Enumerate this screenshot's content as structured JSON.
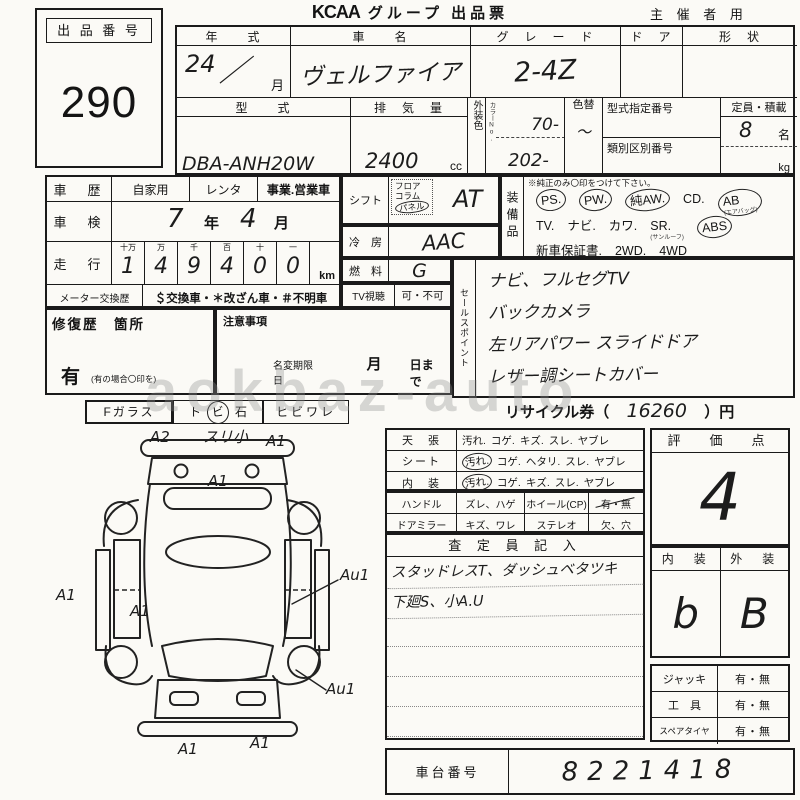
{
  "header": {
    "logo": "KCAA",
    "title": "グループ 出品票",
    "audience": "主 催 者 用"
  },
  "lot": {
    "label": "出 品 番 号",
    "number": "290"
  },
  "top": {
    "year": {
      "label": "年　　式",
      "value": "24",
      "slash": "／",
      "month": "月"
    },
    "name": {
      "label": "車　　名",
      "value": "ヴェルファイア"
    },
    "grade": {
      "label": "グ　レ　ー　ド",
      "value": "2-4Z"
    },
    "door": {
      "label": "ド　ア"
    },
    "shape": {
      "label": "形　状"
    },
    "model": {
      "label": "型　　式",
      "value": "DBA-ANH20W"
    },
    "disp": {
      "label": "排　気　量",
      "value": "2400",
      "unit": "cc"
    },
    "color": {
      "label": "外装色",
      "sub": "カラーNo.",
      "top": "70-",
      "bottom": "202-"
    },
    "colorchg": {
      "label": "色替",
      "value": "〜"
    },
    "typenum": {
      "label": "型式指定番号"
    },
    "classnum": {
      "label": "類別区別番号"
    },
    "capacity": {
      "label": "定員・積載",
      "value": "8",
      "unit1": "名",
      "unit2": "kg"
    }
  },
  "history": {
    "use": {
      "label": "車　歴",
      "options": [
        "自家用",
        "レンタ",
        "事業.営業車"
      ]
    },
    "shaken": {
      "label": "車　検",
      "year": "7",
      "year_unit": "年",
      "month": "4",
      "month_unit": "月"
    },
    "odo": {
      "label": "走　行",
      "columns": [
        {
          "h": "十万",
          "d": "1"
        },
        {
          "h": "万",
          "d": "4"
        },
        {
          "h": "千",
          "d": "9"
        },
        {
          "h": "百",
          "d": "4"
        },
        {
          "h": "十",
          "d": "0"
        },
        {
          "h": "一",
          "d": "0"
        }
      ],
      "unit": "km"
    },
    "meter": {
      "label": "メーター交換歴",
      "legend": "＄交換車・＊改ざん車・＃不明車"
    }
  },
  "tv": {
    "label": "TV視聴",
    "value": "可・不可"
  },
  "shift": {
    "label": "シフト",
    "options": [
      {
        "t": "フロア"
      },
      {
        "t": "コラム"
      },
      {
        "t": "パネル",
        "c": 1
      }
    ],
    "value": "AT"
  },
  "ac": {
    "label": "冷　房",
    "value": "AAC"
  },
  "fuel": {
    "label": "燃　料",
    "value": "G"
  },
  "repair": {
    "label": "修復歴　箇所",
    "flag": "有",
    "note": "(有の場合〇印を)"
  },
  "caution": {
    "label": "注意事項",
    "rename": "名変期限日",
    "month": "月",
    "until": "日まで"
  },
  "equipment": {
    "label": "装備品",
    "note": "※純正のみ〇印をつけて下さい。",
    "lines": [
      [
        {
          "t": "PS.",
          "c": 1
        },
        {
          "t": "PW.",
          "c": 1
        },
        {
          "t": "純AW.",
          "c": 1
        },
        {
          "t": "CD."
        },
        {
          "t": "AB",
          "c": 1,
          "sub": "(エアバッグ)"
        }
      ],
      [
        {
          "t": "TV."
        },
        {
          "t": "ナビ."
        },
        {
          "t": "カワ."
        },
        {
          "t": "SR.",
          "sub": "(サンルーフ)"
        },
        {
          "t": "ABS",
          "c": 1
        }
      ],
      [
        {
          "t": "新車保証書."
        },
        {
          "t": "2WD."
        },
        {
          "t": "4WD"
        }
      ]
    ]
  },
  "sales": {
    "label": "セールスポイント",
    "lines": [
      "ナビ、フルセグTV",
      "バックカメラ",
      "左リアパワー スライドドア",
      "レザー調シートカバー"
    ]
  },
  "glass": {
    "label": "Fガラス",
    "parts": [
      {
        "t": "ト"
      },
      {
        "t": "ビ",
        "c": 1
      },
      {
        "t": "石"
      }
    ],
    "crack": "ヒビワレ"
  },
  "recycle": {
    "prefix": "リサイクル券（",
    "value": "16260",
    "suffix": "）円"
  },
  "condition": {
    "rows": [
      {
        "label": "天　張",
        "options": [
          {
            "t": "汚れ."
          },
          {
            "t": "コゲ."
          },
          {
            "t": "キズ."
          },
          {
            "t": "スレ."
          },
          {
            "t": "ヤブレ"
          }
        ]
      },
      {
        "label": "シート",
        "options": [
          {
            "t": "汚れ.",
            "c": 1
          },
          {
            "t": "コゲ."
          },
          {
            "t": "ヘタリ."
          },
          {
            "t": "スレ."
          },
          {
            "t": "ヤブレ"
          }
        ]
      },
      {
        "label": "内　装",
        "options": [
          {
            "t": "汚れ.",
            "c": 1
          },
          {
            "t": "コゲ."
          },
          {
            "t": "キズ."
          },
          {
            "t": "スレ."
          },
          {
            "t": "ヤブレ"
          }
        ]
      }
    ],
    "rows2": [
      {
        "cells": [
          "ハンドル",
          "ズレ、ハゲ",
          "ホイール(CP)",
          "有・無"
        ],
        "marked": true
      },
      {
        "cells": [
          "ドアミラー",
          "キズ、ワレ",
          "ステレオ",
          "欠、穴"
        ],
        "marked": false
      }
    ]
  },
  "inspector": {
    "header": "査 定 員 記 入",
    "lines": [
      "スタッドレスT、ダッシュベタツキ",
      "下廻S、小A.U"
    ]
  },
  "score": {
    "label": "評　価　点",
    "value": "4"
  },
  "grades": {
    "int_label": "内　装",
    "ext_label": "外　装",
    "int": "b",
    "ext": "B"
  },
  "accessories": {
    "rows": [
      {
        "label": "ジャッキ",
        "value": "有・無"
      },
      {
        "label": "工　具",
        "value": "有・無"
      },
      {
        "label": "スペアタイヤ",
        "value": "有・無"
      }
    ]
  },
  "chassis": {
    "label": "車台番号",
    "value": "8221418"
  },
  "watermark": "aokbaz-auto",
  "diagram": {
    "annotations": [
      {
        "t": "A2",
        "x": 110,
        "y": 0
      },
      {
        "t": "スリ小",
        "x": 163,
        "y": -2
      },
      {
        "t": "A1",
        "x": 226,
        "y": 4
      },
      {
        "t": "A1",
        "x": 168,
        "y": 44
      },
      {
        "t": "A1",
        "x": 16,
        "y": 158
      },
      {
        "t": "A1",
        "x": 90,
        "y": 174
      },
      {
        "t": "Au1",
        "x": 300,
        "y": 138
      },
      {
        "t": "Au1",
        "x": 286,
        "y": 252
      },
      {
        "t": "A1",
        "x": 138,
        "y": 312
      },
      {
        "t": "A1",
        "x": 210,
        "y": 306
      }
    ]
  }
}
